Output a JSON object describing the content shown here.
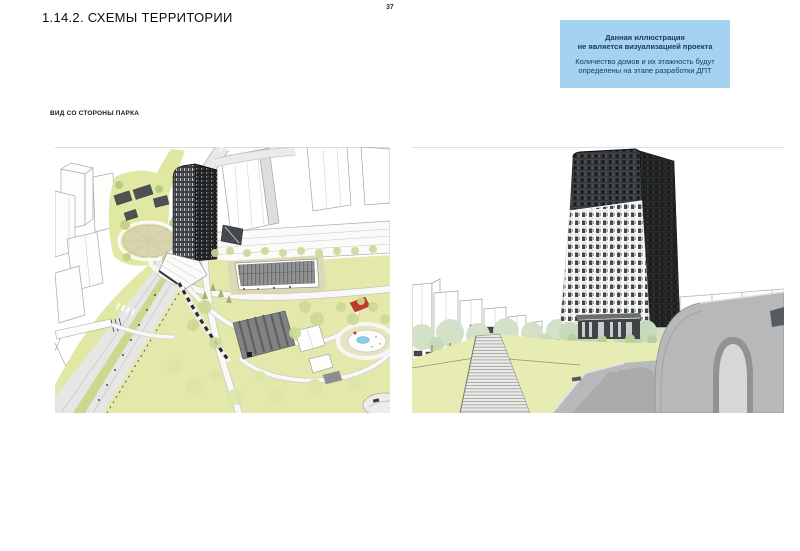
{
  "page": {
    "title": "1.14.2. СХЕМЫ ТЕРРИТОРИИ",
    "page_number": "37"
  },
  "disclaimer": {
    "heading_lines": [
      "Данная иллюстрация",
      "не является визуализацией проекта"
    ],
    "body_lines": [
      "Количество домов и их этажность будут",
      "определены на этапе разработки ДПТ"
    ],
    "background": "#a5d2ef",
    "text_color": "#1f3864"
  },
  "figures": {
    "view_label": "ВИД СО СТОРОНЫ ПАРКА",
    "left_illustration": "site-plan-aerial-view",
    "right_illustration": "street-level-view"
  },
  "palette": {
    "grass_green": "#e4e9ab",
    "tree_green": "#ccd994",
    "pale_tree_green": "#d2e1c8",
    "road_gray": "#b7b9bb",
    "path_gray": "#e9e9e7",
    "tower_dark": "#202224",
    "concrete_gray": "#b6b8b9",
    "pond_blue": "#8ccbe9",
    "accent_red": "#c0392b",
    "trunk_orange": "#b5613b"
  }
}
